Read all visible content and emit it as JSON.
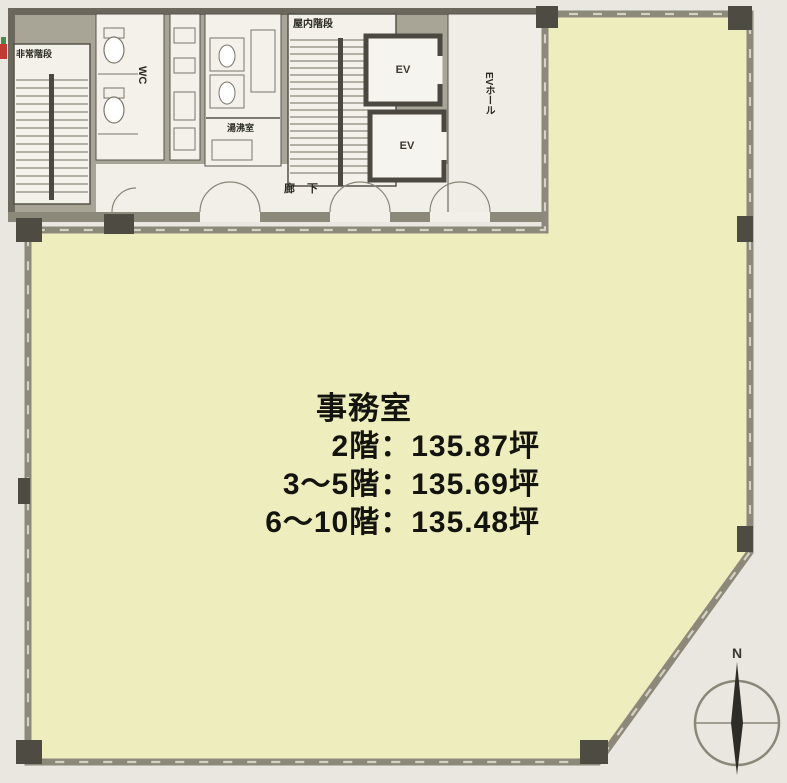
{
  "plan_type": "office-floor-plan",
  "colors": {
    "office_fill": "#eeedbe",
    "outer_wall": "#8d897a",
    "pillar": "#4e4b42",
    "core_background": "#a8a496",
    "room_fill": "#f3f1ea",
    "background": "#e9e7e0",
    "text": "#14140f",
    "edge_mark_red": "#c03a32",
    "edge_mark_green": "#4a8a4a"
  },
  "rooms": {
    "emergency_stairs": "非常階段",
    "wc": "WC",
    "hot_water_room": "湯沸室",
    "indoor_stairs": "屋内階段",
    "elevator_1": "EV",
    "elevator_2": "EV",
    "elevator_hall": "EVホール",
    "corridor": "廊下"
  },
  "office": {
    "title": "事務室",
    "area_lines": [
      "2階：135.87坪",
      "3〜5階：135.69坪",
      "6〜10階：135.48坪"
    ]
  },
  "compass": {
    "north_label": "N"
  }
}
